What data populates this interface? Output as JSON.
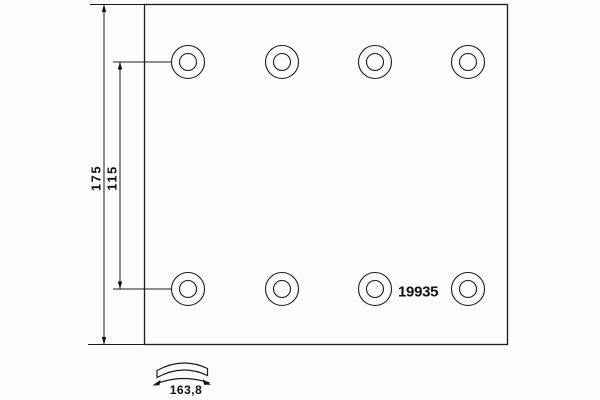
{
  "drawing": {
    "part_number": "19935",
    "dimensions": {
      "overall_height": "175",
      "hole_row_spacing": "115",
      "arc_width": "163,8"
    },
    "holes": {
      "count": 8,
      "rows": 2,
      "per_row": 4
    },
    "colors": {
      "line": "#1c1c1c",
      "background": "#fcfcfc",
      "text": "#111111"
    }
  }
}
